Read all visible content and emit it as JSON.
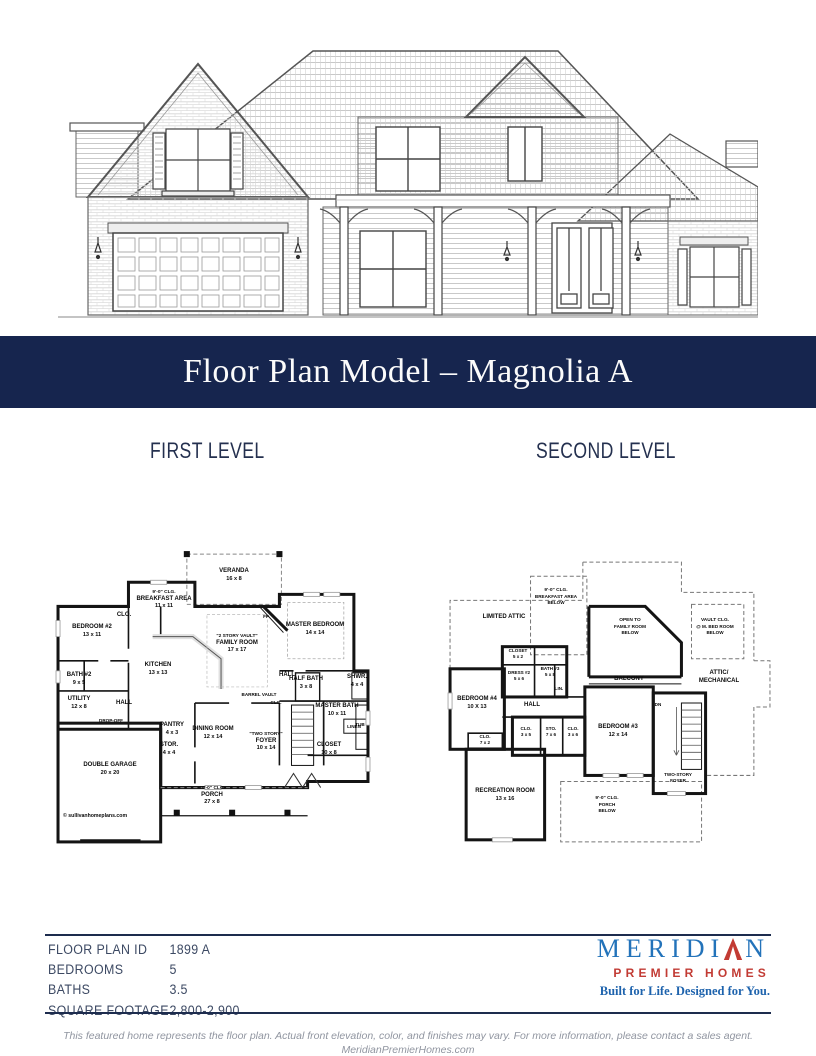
{
  "banner": {
    "title": "Floor Plan Model – Magnolia A"
  },
  "levels": {
    "first": "FIRST LEVEL",
    "second": "SECOND LEVEL"
  },
  "fl": {
    "veranda": {
      "name": "VERANDA",
      "dims": "16 x 8"
    },
    "breakfast": {
      "note": "9'-0\" CLG.",
      "name": "BREAKFAST AREA",
      "dims": "11 x 11"
    },
    "bedroom2": {
      "name": "BEDROOM #2",
      "dims": "13 x 11"
    },
    "clo": {
      "name": "CLO."
    },
    "kitchen": {
      "name": "KITCHEN",
      "dims": "13 x 13"
    },
    "family": {
      "note": "\"2 STORY VAULT\"",
      "name": "FAMILY ROOM",
      "dims": "17 x 17"
    },
    "fp": {
      "name": "FP"
    },
    "master_bedroom": {
      "name": "MASTER BEDROOM",
      "dims": "14 x 14"
    },
    "bath2": {
      "name": "BATH #2",
      "dims": "9 x 5"
    },
    "utility": {
      "name": "UTILITY",
      "dims": "12 x 8"
    },
    "hall_left": {
      "name": "HALL"
    },
    "hall_right": {
      "name": "HALL"
    },
    "half_bath": {
      "name": "HALF BATH",
      "dims": "3 x 8"
    },
    "shower": {
      "name": "SHWR.",
      "dims": "4 x 4"
    },
    "master_bath": {
      "name": "MASTER BATH",
      "dims": "10 x 11"
    },
    "tub": {
      "name": "TUB"
    },
    "barrel_vault": {
      "name": "BARREL VAULT"
    },
    "clg": {
      "name": "CLG."
    },
    "pantry": {
      "name": "PANTRY",
      "dims": "4 x 3"
    },
    "storage": {
      "name": "STOR.",
      "dims": "4 x 4"
    },
    "dining": {
      "name": "DINING ROOM",
      "dims": "12 x 14"
    },
    "foyer": {
      "note": "\"TWO STORY\"",
      "name": "FOYER",
      "dims": "10 x 14"
    },
    "closet": {
      "name": "CLOSET",
      "dims": "10 x 8"
    },
    "linen": {
      "name": "LINEN"
    },
    "drop_off": {
      "name": "DROP-OFF"
    },
    "garage": {
      "name": "DOUBLE GARAGE",
      "dims": "20 x 20"
    },
    "porch": {
      "note": "10'-0\" CLG.",
      "name": "PORCH",
      "dims": "27 x 8"
    },
    "copyright": "© sullivanhomeplans.com"
  },
  "sl": {
    "limited_attic": {
      "name": "LIMITED ATTIC"
    },
    "breakfast_below": {
      "note": "9'-0\" CLG.",
      "name": "BREAKFAST AREA",
      "below": "BELOW"
    },
    "open_family": {
      "line1": "OPEN TO",
      "name": "FAMILY ROOM",
      "below": "BELOW"
    },
    "mbed_below": {
      "note": "VAULT CLG.",
      "name": "@ M. BED ROOM",
      "below": "BELOW"
    },
    "attic_mech": {
      "name": "ATTIC/",
      "name2": "MECHANICAL"
    },
    "balcony": {
      "name": "BALCONY"
    },
    "closet": {
      "name": "CLOSET",
      "dims": "5 x 2"
    },
    "bath3": {
      "name": "BATH #3",
      "dims": "5 x 8"
    },
    "dress2": {
      "name": "DRESS #2",
      "dims": "5 x 6"
    },
    "lin": {
      "name": "LIN."
    },
    "bedroom4": {
      "name": "BEDROOM #4",
      "dims": "10 X 13"
    },
    "hall": {
      "name": "HALL"
    },
    "clo_hall": {
      "name": "CLO.",
      "dims": "7 x 2"
    },
    "clo_left": {
      "name": "CLO.",
      "dims": "3 x 5"
    },
    "sto": {
      "name": "STO.",
      "dims": "7 x 6"
    },
    "clo_right": {
      "name": "CLO.",
      "dims": "3 x 6"
    },
    "bedroom3": {
      "name": "BEDROOM #3",
      "dims": "12 x 14"
    },
    "foyer": {
      "name": "TWO-STORY",
      "name2": "FOYER"
    },
    "dn": {
      "name": "DN"
    },
    "recreation": {
      "name": "RECREATION ROOM",
      "dims": "13 x 16"
    },
    "porch_below": {
      "note": "9'-0\" CLG.",
      "name": "PORCH",
      "below": "BELOW"
    }
  },
  "specs": {
    "rows": [
      {
        "label": "FLOOR PLAN ID",
        "value": "1899 A"
      },
      {
        "label": "BEDROOMS",
        "value": "5"
      },
      {
        "label": "BATHS",
        "value": "3.5"
      },
      {
        "label": "SQUARE FOOTAGE",
        "value": "2,800-2,900"
      }
    ]
  },
  "logo": {
    "word_left": "MERIDI",
    "word_right": "N",
    "subtitle": "PREMIER HOMES",
    "tagline": "Built for Life. Designed for You."
  },
  "footer": {
    "disclaimer": "This featured home represents the floor plan. Actual front elevation, color, and finishes may vary. For more information, please contact a sales agent.",
    "website": "MeridianPremierHomes.com"
  },
  "colors": {
    "banner_navy": "#16254e",
    "heading_navy": "#24304f",
    "rule_navy": "#1d2c4e",
    "logo_blue": "#2373ba",
    "logo_red": "#c23b34",
    "tagline_blue": "#1e63ad",
    "spec_text": "#3c4963",
    "disclaimer_gray": "#9095a0"
  }
}
